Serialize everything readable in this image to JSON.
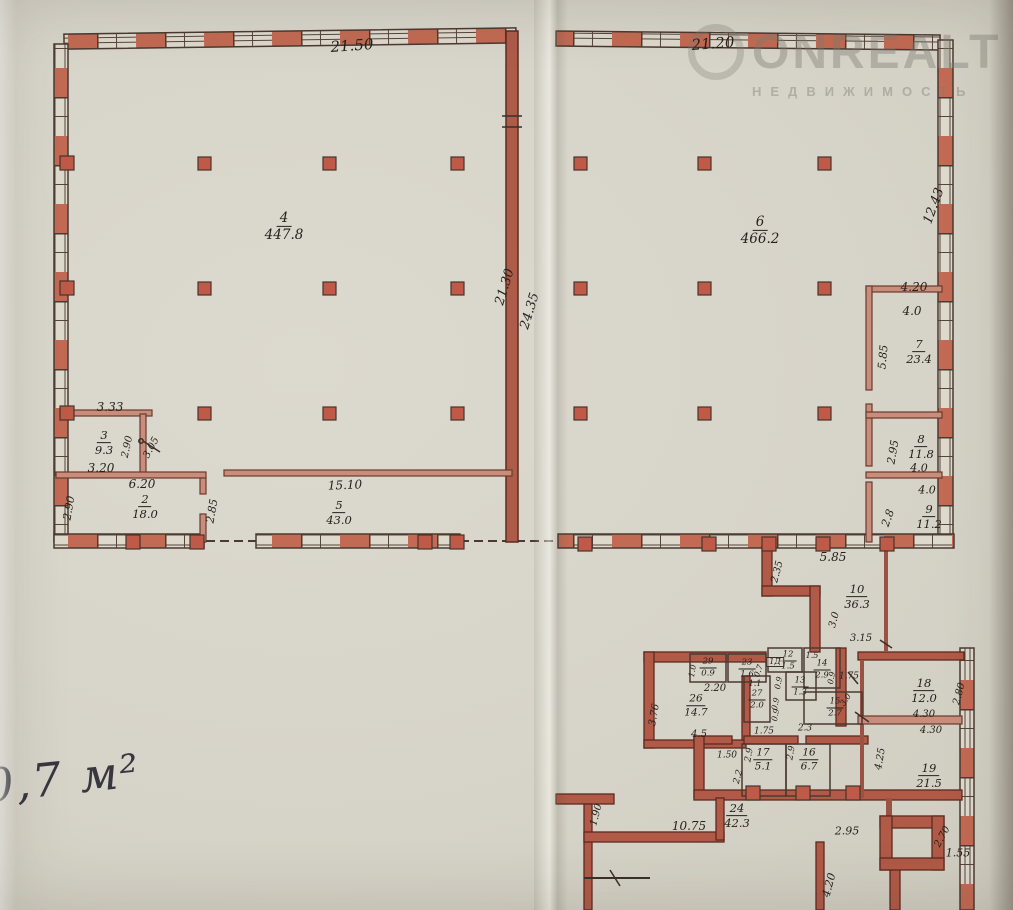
{
  "document": {
    "handwritten_note": "0,7 м²",
    "watermark": {
      "brand": "ONREALT",
      "subtitle": "НЕДВИЖИМОСТЬ"
    }
  },
  "colors": {
    "paper": "#d8d5cb",
    "wall_red": "#b05a47",
    "pier_red": "#c26a53",
    "ink": "#26201b"
  },
  "plan": {
    "rooms": [
      {
        "number": "2",
        "area": "18.0",
        "x": 145,
        "y": 507,
        "s": 11.5
      },
      {
        "number": "3",
        "area": "9.3",
        "x": 104,
        "y": 443,
        "s": 11.5
      },
      {
        "number": "4",
        "area": "447.8",
        "x": 284,
        "y": 227,
        "s": 13.5
      },
      {
        "number": "5",
        "area": "43.0",
        "x": 339,
        "y": 513,
        "s": 11.5
      },
      {
        "number": "6",
        "area": "466.2",
        "x": 760,
        "y": 231,
        "s": 13.5
      },
      {
        "number": "7",
        "area": "23.4",
        "x": 919,
        "y": 352,
        "s": 11.5
      },
      {
        "number": "8",
        "area": "11.8",
        "x": 921,
        "y": 447,
        "s": 11.5
      },
      {
        "number": "9",
        "area": "11.2",
        "x": 929,
        "y": 517,
        "s": 11.5
      },
      {
        "number": "10",
        "area": "36.3",
        "x": 857,
        "y": 597,
        "s": 11.5
      },
      {
        "number": "12",
        "area": "1.5",
        "x": 788,
        "y": 661,
        "s": 8.5
      },
      {
        "number": "13",
        "area": "1.3",
        "x": 800,
        "y": 687,
        "s": 8.5
      },
      {
        "number": "14",
        "area": "2.9",
        "x": 822,
        "y": 670,
        "s": 8.5
      },
      {
        "number": "15",
        "area": "2.7",
        "x": 835,
        "y": 708,
        "s": 8.5
      },
      {
        "number": "16",
        "area": "6.7",
        "x": 809,
        "y": 760,
        "s": 10.5
      },
      {
        "number": "17",
        "area": "5.1",
        "x": 763,
        "y": 760,
        "s": 10.5
      },
      {
        "number": "18",
        "area": "12.0",
        "x": 924,
        "y": 691,
        "s": 11.5
      },
      {
        "number": "19",
        "area": "21.5",
        "x": 929,
        "y": 776,
        "s": 11.5
      },
      {
        "number": "23",
        "area": "1.6",
        "x": 747,
        "y": 669,
        "s": 8.5
      },
      {
        "number": "24",
        "area": "42.3",
        "x": 737,
        "y": 816,
        "s": 11.5
      },
      {
        "number": "26",
        "area": "14.7",
        "x": 696,
        "y": 706,
        "s": 10.5
      },
      {
        "number": "27",
        "area": "2.0",
        "x": 757,
        "y": 700,
        "s": 8.5
      },
      {
        "number": "29",
        "area": "0.9",
        "x": 708,
        "y": 668,
        "s": 8.5
      }
    ],
    "dimensions": [
      {
        "t": "21.50",
        "x": 352,
        "y": 46,
        "r": -4,
        "s": 15
      },
      {
        "t": "21.20",
        "x": 713,
        "y": 44,
        "r": -4,
        "s": 15
      },
      {
        "t": "21.30",
        "x": 505,
        "y": 287,
        "r": -73,
        "s": 13
      },
      {
        "t": "24.35",
        "x": 530,
        "y": 311,
        "r": -73,
        "s": 13
      },
      {
        "t": "12.43",
        "x": 934,
        "y": 206,
        "r": -70,
        "s": 13
      },
      {
        "t": "4.20",
        "x": 914,
        "y": 287,
        "r": 0,
        "s": 12
      },
      {
        "t": "4.0",
        "x": 912,
        "y": 311,
        "r": 0,
        "s": 12
      },
      {
        "t": "5.85",
        "x": 883,
        "y": 357,
        "r": -85,
        "s": 11
      },
      {
        "t": "2.95",
        "x": 893,
        "y": 452,
        "r": -80,
        "s": 11
      },
      {
        "t": "4.0",
        "x": 919,
        "y": 468,
        "r": 0,
        "s": 11
      },
      {
        "t": "4.0",
        "x": 927,
        "y": 490,
        "r": 0,
        "s": 11
      },
      {
        "t": "2.8",
        "x": 888,
        "y": 518,
        "r": -70,
        "s": 11
      },
      {
        "t": "3.33",
        "x": 110,
        "y": 407,
        "r": 0,
        "s": 12
      },
      {
        "t": "2.90",
        "x": 128,
        "y": 447,
        "r": -78,
        "s": 10
      },
      {
        "t": "3.05",
        "x": 152,
        "y": 448,
        "r": -62,
        "s": 10
      },
      {
        "t": "3.20",
        "x": 101,
        "y": 468,
        "r": 0,
        "s": 12
      },
      {
        "t": "6.20",
        "x": 142,
        "y": 484,
        "r": 0,
        "s": 12
      },
      {
        "t": "2.90",
        "x": 69,
        "y": 508,
        "r": -80,
        "s": 11
      },
      {
        "t": "2.85",
        "x": 212,
        "y": 511,
        "r": -80,
        "s": 11
      },
      {
        "t": "15.10",
        "x": 345,
        "y": 485,
        "r": -2,
        "s": 12
      },
      {
        "t": "5.85",
        "x": 833,
        "y": 557,
        "r": 0,
        "s": 12
      },
      {
        "t": "2.35",
        "x": 778,
        "y": 572,
        "r": -75,
        "s": 10
      },
      {
        "t": "3.0",
        "x": 835,
        "y": 620,
        "r": -75,
        "s": 10
      },
      {
        "t": "3.15",
        "x": 861,
        "y": 639,
        "r": 0,
        "s": 10
      },
      {
        "t": "1.75",
        "x": 849,
        "y": 677,
        "r": 0,
        "s": 9
      },
      {
        "t": "1.5",
        "x": 812,
        "y": 656,
        "r": 0,
        "s": 8
      },
      {
        "t": "1Д",
        "x": 775,
        "y": 662,
        "r": 0,
        "s": 8,
        "boxed": true
      },
      {
        "t": "1.0",
        "x": 693,
        "y": 671,
        "r": -80,
        "s": 8
      },
      {
        "t": "0.7",
        "x": 759,
        "y": 671,
        "r": -70,
        "s": 8
      },
      {
        "t": "2.20",
        "x": 715,
        "y": 689,
        "r": 0,
        "s": 10
      },
      {
        "t": "1.1",
        "x": 755,
        "y": 684,
        "r": 0,
        "s": 8
      },
      {
        "t": "0.9",
        "x": 779,
        "y": 683,
        "r": -80,
        "s": 8
      },
      {
        "t": "0.9",
        "x": 832,
        "y": 678,
        "r": -80,
        "s": 8
      },
      {
        "t": "3.0",
        "x": 846,
        "y": 700,
        "r": -55,
        "s": 8
      },
      {
        "t": "0.9",
        "x": 776,
        "y": 704,
        "r": -80,
        "s": 8
      },
      {
        "t": "0.9",
        "x": 776,
        "y": 715,
        "r": -80,
        "s": 8
      },
      {
        "t": "3.76",
        "x": 655,
        "y": 715,
        "r": -80,
        "s": 10
      },
      {
        "t": "4.5",
        "x": 699,
        "y": 735,
        "r": 0,
        "s": 10
      },
      {
        "t": "1.50",
        "x": 727,
        "y": 756,
        "r": 0,
        "s": 9
      },
      {
        "t": "2.2",
        "x": 739,
        "y": 777,
        "r": -75,
        "s": 9
      },
      {
        "t": "2.9",
        "x": 750,
        "y": 755,
        "r": -80,
        "s": 9
      },
      {
        "t": "2.9",
        "x": 792,
        "y": 753,
        "r": -80,
        "s": 9
      },
      {
        "t": "1.75",
        "x": 764,
        "y": 732,
        "r": 0,
        "s": 9
      },
      {
        "t": "2.3",
        "x": 805,
        "y": 729,
        "r": 0,
        "s": 9
      },
      {
        "t": "2.80",
        "x": 960,
        "y": 694,
        "r": -75,
        "s": 10
      },
      {
        "t": "4.30",
        "x": 924,
        "y": 715,
        "r": 0,
        "s": 10
      },
      {
        "t": "4.30",
        "x": 931,
        "y": 731,
        "r": 0,
        "s": 10
      },
      {
        "t": "4.25",
        "x": 881,
        "y": 759,
        "r": -80,
        "s": 10
      },
      {
        "t": "1.90",
        "x": 597,
        "y": 815,
        "r": -75,
        "s": 10
      },
      {
        "t": "10.75",
        "x": 689,
        "y": 826,
        "r": 0,
        "s": 12
      },
      {
        "t": "2.95",
        "x": 847,
        "y": 831,
        "r": 0,
        "s": 11
      },
      {
        "t": "4.20",
        "x": 829,
        "y": 885,
        "r": -75,
        "s": 11
      },
      {
        "t": "2.70",
        "x": 943,
        "y": 837,
        "r": -62,
        "s": 10
      },
      {
        "t": "1.55",
        "x": 958,
        "y": 853,
        "r": 0,
        "s": 11
      }
    ]
  }
}
